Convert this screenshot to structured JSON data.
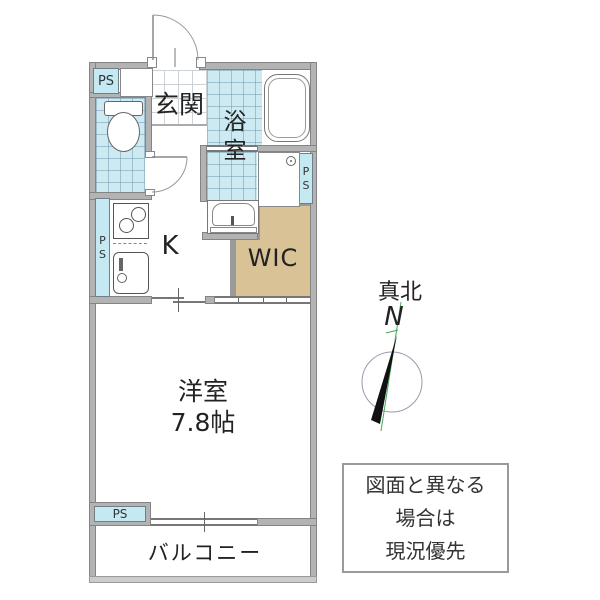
{
  "floorplan": {
    "pipe_space": "PS",
    "rooms": {
      "genkan": "玄関",
      "bathroom": "浴室",
      "kitchen": "K",
      "wic": "WIC",
      "western_room": "洋室",
      "western_room_size": "7.8帖",
      "balcony": "バルコニー"
    },
    "compass": {
      "true_north": "真北",
      "north": "N"
    },
    "disclaimer": {
      "line1": "図面と異なる",
      "line2": "場合は",
      "line3": "現況優先"
    },
    "colors": {
      "tile_blue": "#cde9f2",
      "wic_tan": "#d8c296",
      "wall_gray": "#b3b3b3",
      "compass_line_green": "#44aa55",
      "text": "#222222"
    }
  }
}
